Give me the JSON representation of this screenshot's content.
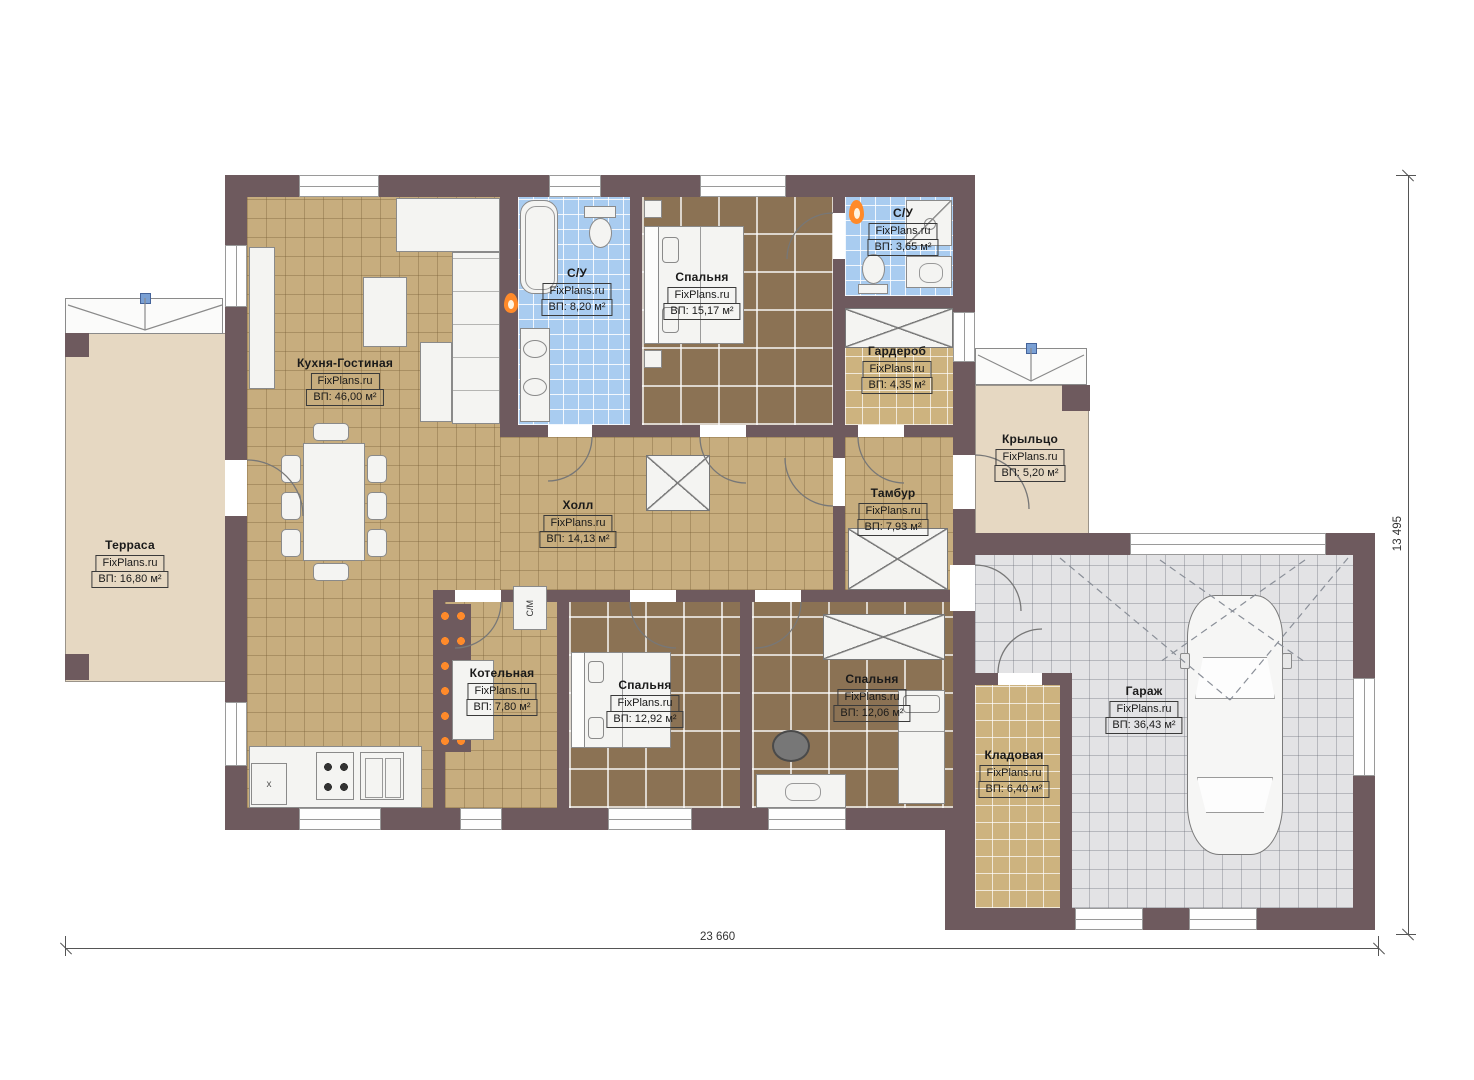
{
  "watermark": "FixPlans.ru",
  "rooms": [
    {
      "name": "Терраса",
      "area": "ВП: 16,80 м²"
    },
    {
      "name": "Кухня-Гостиная",
      "area": "ВП: 46,00 м²"
    },
    {
      "name": "С/У",
      "area": "ВП: 8,20 м²"
    },
    {
      "name": "Спальня",
      "area": "ВП: 15,17 м²"
    },
    {
      "name": "С/У",
      "area": "ВП: 3,65 м²"
    },
    {
      "name": "Гардероб",
      "area": "ВП: 4,35 м²"
    },
    {
      "name": "Холл",
      "area": "ВП: 14,13 м²"
    },
    {
      "name": "Тамбур",
      "area": "ВП: 7,93 м²"
    },
    {
      "name": "Крыльцо",
      "area": "ВП: 5,20 м²"
    },
    {
      "name": "Котельная",
      "area": "ВП: 7,80 м²"
    },
    {
      "name": "Спальня",
      "area": "ВП: 12,92 м²"
    },
    {
      "name": "Спальня",
      "area": "ВП: 12,06 м²"
    },
    {
      "name": "Кладовая",
      "area": "ВП: 6,40 м²"
    },
    {
      "name": "Гараж",
      "area": "ВП: 36,43 м²"
    }
  ],
  "dimensions": {
    "bottom": "23 660",
    "right": "13 495"
  },
  "annotations": {
    "washing_machine": "С/М",
    "hatch": "x"
  },
  "colors": {
    "wall": "#6e5a5e",
    "floor_tan": "#c7ad7e",
    "floor_brown": "#8b7254",
    "floor_blue": "#a9ccf0",
    "floor_gray": "#e3e3e5",
    "floor_beige": "#e6d8c2",
    "floor_storage": "#cdb37f",
    "flame_orange": "#ff8a2a"
  }
}
